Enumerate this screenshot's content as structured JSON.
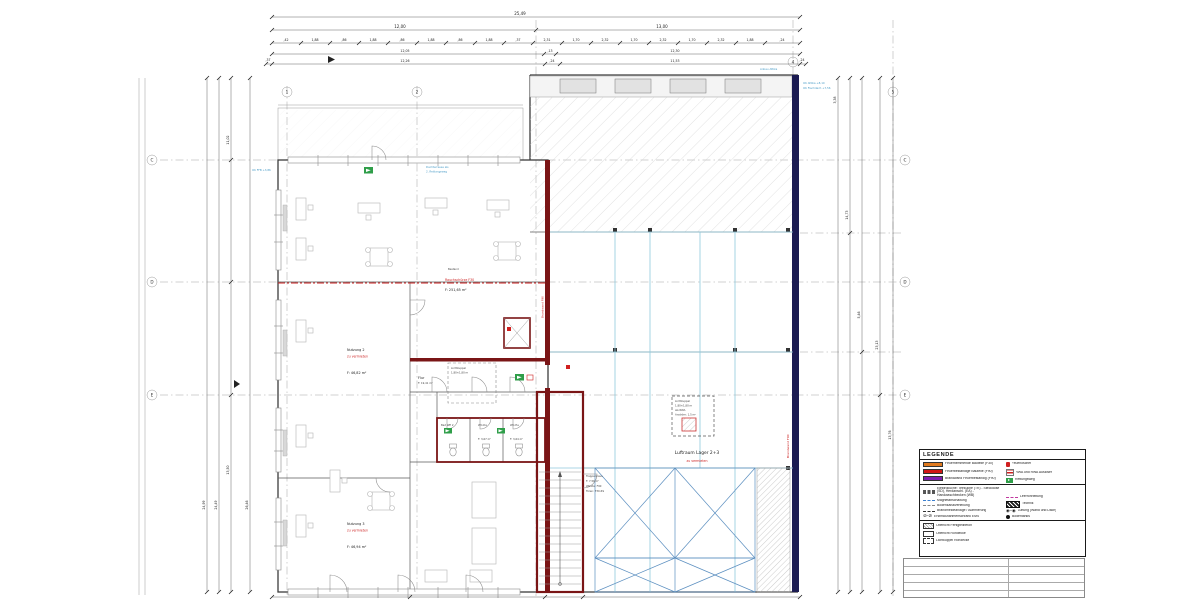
{
  "colors": {
    "wall_red": "#7a1516",
    "wall_navy": "#1b1b52",
    "accent_red": "#cc2222",
    "cyan_partition": "#8fc9dc",
    "brace_blue": "#5b8fc0",
    "annotation_blue": "#4a9cc7",
    "exit_green": "#2f9e49",
    "legend_orange": "#e07a1f",
    "legend_red": "#d01616",
    "legend_purple": "#7d1fb0"
  },
  "dims": {
    "top_total": "25,49",
    "top_row2": [
      "12,00",
      "13,00"
    ],
    "top_row3": [
      ",42",
      "1,88",
      ",86",
      "1,88",
      ",86",
      "1,88",
      ",86",
      "1,88",
      ",37",
      "2,31",
      "1,70",
      "2,32",
      "1,70",
      "2,32",
      "1,70",
      "2,32",
      "1,88",
      ",24"
    ],
    "top_row4": [
      "12,05",
      ",13",
      "12,30"
    ],
    "top_row5": [
      ",37",
      "12,26",
      ",24",
      "11,53",
      ",24"
    ],
    "left": [
      "24,99",
      "24,49",
      "11,02",
      "13,50",
      "26,46"
    ],
    "right": [
      "3,38",
      "14,73",
      "5,46",
      "23,13",
      "13,76"
    ]
  },
  "axes": {
    "top": [
      "1",
      "2",
      "3",
      "4",
      "5"
    ],
    "left": [
      "C",
      "D",
      "E"
    ],
    "right": [
      "C",
      "D",
      "E"
    ]
  },
  "rooms": {
    "buero": {
      "area": "F: 251,65 m²"
    },
    "nutzung2": {
      "name": "Nutzung 2",
      "status": "zu vermieten",
      "area": "F: 46,82 m²"
    },
    "nutzung3": {
      "name": "Nutzung 3",
      "status": "zu vermieten",
      "area": "F: 46,94 m²"
    },
    "luftraum": {
      "name": "Luftraum Lager 2+3",
      "status": "zu vermieten"
    },
    "treppenhaus": {
      "name": "Treppenhaus",
      "area": "F: 7,56 m²",
      "note1": "Wände: F90",
      "note2": "Türen: T30-RS"
    },
    "flur": {
      "name": "Flur",
      "area": "F: 19,41 m²"
    },
    "wc_da": {
      "name": "WC-Da",
      "area": "F: 3,67 m²"
    },
    "wc_he": {
      "name": "WC-He",
      "area": "F: 3,64 m²"
    },
    "bad": {
      "name": "Bad WE 2"
    }
  },
  "annotations": {
    "bestand": "Bestand",
    "rauchschuerze": "Rauchschürze F30",
    "brandwand_right": "Brandwand F90",
    "brandwand_mid": "Brandwand F90",
    "dachterrasse1": "Dachterrasse als",
    "dachterrasse2": "2. Rettungsweg",
    "attika": "Anbau Attika",
    "oka1": "OK Attika +8,10",
    "oka2": "OK Flachdach +7,56",
    "ok_ffb": "OK FFB +3,86",
    "lk_box": [
      "Lichtkuppel",
      "1,80×1,80 m",
      "als RWA",
      "Anström: 1,5 m²"
    ],
    "lk_flur": [
      "Lichtkuppel",
      "1,80×1,80 m"
    ]
  },
  "legend": {
    "title": "LEGENDE",
    "fire": [
      {
        "color": "#e07a1f",
        "label": "Feuerhemmende Bauteile (F30)"
      },
      {
        "color": "#d01616",
        "label": "Feuerbeständige Bauteile (F90)"
      },
      {
        "color": "#7d1fb0",
        "label": "Brandwand Feuerbeständig (F90)"
      }
    ],
    "safety": [
      {
        "label": "Feuerlöscher"
      },
      {
        "label": "RWA und RWA Auslöser"
      },
      {
        "label": "Rettungsweg"
      }
    ],
    "install_left": [
      {
        "label": "Elektroküche: Teeküche (TK) - Steckdose (SD), Herdanschl. (EA) - Handwaschbecken (WB)"
      },
      {
        "label": "Magnetabschaltung"
      },
      {
        "label": "Bodenkanalverteilung"
      },
      {
        "label": "Brandmeldeanlage / Alarmierung"
      },
      {
        "label": "Erstmaßnahmenschrank EMS"
      }
    ],
    "install_right": [
      {
        "label": "Leerrohrleitung"
      },
      {
        "label": "Technik"
      },
      {
        "label": "Lüftung (Wand und Dach)"
      },
      {
        "label": "Bodentanks"
      }
    ],
    "openings": [
      {
        "label": "Oberlicht Fertigteilbeton"
      },
      {
        "label": "Oberlicht Rohdecke"
      },
      {
        "label": "Lichtkuppel Rohdecke"
      }
    ]
  }
}
